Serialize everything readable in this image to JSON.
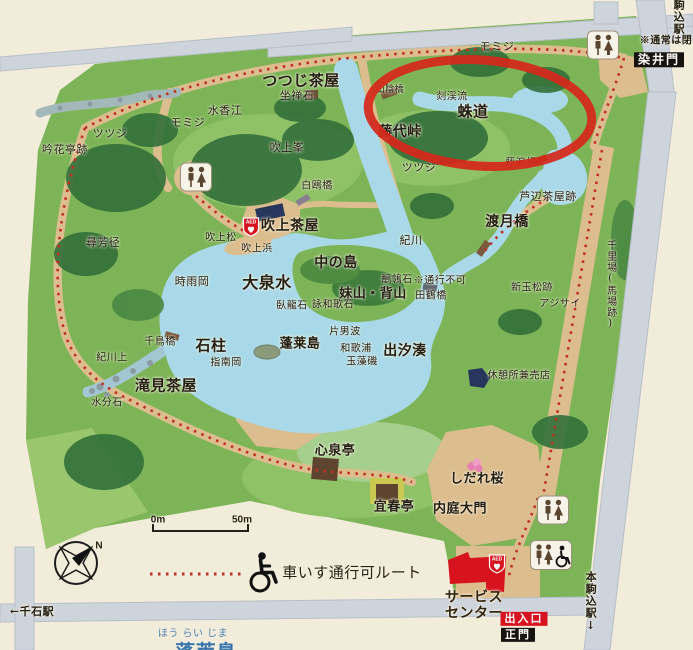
{
  "colors": {
    "paper": "#f2ecda",
    "park_green": "#7db457",
    "lake_blue": "#a9d9e8",
    "road_gray": "#ced4dc",
    "path_tan": "#dcbd8e",
    "route_red_dots": "#bf2f22",
    "annotation_red": "#d5281b",
    "gate_black": "#17130e",
    "entrance_red": "#d7131f",
    "caption_blue": "#4a7fad",
    "label_dark": "#241e13"
  },
  "map": {
    "labels": [
      {
        "name": "somei-note",
        "text": "※通常は閉",
        "x": 666,
        "y": 41,
        "size": 10,
        "bold": true
      },
      {
        "name": "komagome-station",
        "text": "駒込駅",
        "x": 678,
        "y": 17,
        "size": 11,
        "bold": true,
        "vertical": true
      },
      {
        "name": "somei-gate",
        "text": "染井門",
        "x": 659,
        "y": 60,
        "size": 12,
        "bold": true,
        "box": "black"
      },
      {
        "name": "momiji-ne",
        "text": "モミジ",
        "x": 497,
        "y": 47,
        "size": 11
      },
      {
        "name": "tsutsuji-chaya",
        "text": "つつじ茶屋",
        "x": 301,
        "y": 81,
        "size": 15,
        "bold": true
      },
      {
        "name": "zazen-ishi",
        "text": "坐禅石",
        "x": 297,
        "y": 96,
        "size": 11
      },
      {
        "name": "yamakage-bashi",
        "text": "山陰橋",
        "x": 390,
        "y": 90,
        "size": 9
      },
      {
        "name": "zankeiryu",
        "text": "剡渓流",
        "x": 452,
        "y": 97,
        "size": 10
      },
      {
        "name": "sasagani-no-michi",
        "text": "蛛道",
        "x": 473,
        "y": 112,
        "size": 15,
        "bold": true
      },
      {
        "name": "fujishiro-toge",
        "text": "藤代峠",
        "x": 400,
        "y": 133,
        "size": 14,
        "bold": true
      },
      {
        "name": "momiji-nw",
        "text": "モミジ",
        "x": 188,
        "y": 123,
        "size": 11
      },
      {
        "name": "suikoe",
        "text": "水香江",
        "x": 225,
        "y": 111,
        "size": 11
      },
      {
        "name": "tsutsuji-west",
        "text": "ツツジ",
        "x": 110,
        "y": 134,
        "size": 11
      },
      {
        "name": "ginkatei-ato",
        "text": "吟花亭跡",
        "x": 65,
        "y": 150,
        "size": 11
      },
      {
        "name": "fukiage-mine",
        "text": "吹上峯",
        "x": 287,
        "y": 148,
        "size": 11
      },
      {
        "name": "tsutsuji-east",
        "text": "ツツジ",
        "x": 419,
        "y": 168,
        "size": 11
      },
      {
        "name": "hakuo-bashi",
        "text": "白鴎橋",
        "x": 317,
        "y": 186,
        "size": 10
      },
      {
        "name": "fujinami-bashi",
        "text": "藤浪橋",
        "x": 521,
        "y": 163,
        "size": 10
      },
      {
        "name": "ashibe-chaya-ato",
        "text": "芦辺茶屋跡",
        "x": 548,
        "y": 197,
        "size": 11
      },
      {
        "name": "togetsu-kyo",
        "text": "渡月橋",
        "x": 507,
        "y": 223,
        "size": 14,
        "bold": true
      },
      {
        "name": "fukiage-chaya",
        "text": "吹上茶屋",
        "x": 290,
        "y": 227,
        "size": 14,
        "bold": true
      },
      {
        "name": "fukiage-matsu",
        "text": "吹上松",
        "x": 221,
        "y": 238,
        "size": 10
      },
      {
        "name": "fukiage-hama",
        "text": "吹上浜",
        "x": 257,
        "y": 249,
        "size": 10
      },
      {
        "name": "ki-no-kawa",
        "text": "紀川",
        "x": 411,
        "y": 241,
        "size": 11
      },
      {
        "name": "jinpokei",
        "text": "尋芳径",
        "x": 103,
        "y": 243,
        "size": 11
      },
      {
        "name": "shigure-oka",
        "text": "時雨岡",
        "x": 192,
        "y": 282,
        "size": 11
      },
      {
        "name": "daisensui",
        "text": "大泉水",
        "x": 267,
        "y": 283,
        "size": 16,
        "bold": true
      },
      {
        "name": "naka-no-shima",
        "text": "中の島",
        "x": 336,
        "y": 264,
        "size": 14,
        "bold": true
      },
      {
        "name": "imoyama-seyama",
        "text": "妹山・背山",
        "x": 373,
        "y": 295,
        "size": 13,
        "bold": true
      },
      {
        "name": "sekirei-ishi",
        "text": "鶺鴒石",
        "x": 397,
        "y": 280,
        "size": 10
      },
      {
        "name": "tsuko-fuka-note",
        "text": "※通行不可",
        "x": 440,
        "y": 281,
        "size": 10
      },
      {
        "name": "tazuru-bashi",
        "text": "田鶴橋",
        "x": 431,
        "y": 296,
        "size": 10
      },
      {
        "name": "garyu-seki",
        "text": "臥龍石",
        "x": 292,
        "y": 306,
        "size": 10
      },
      {
        "name": "eiwaka-ishi",
        "text": "詠和歌石",
        "x": 333,
        "y": 305,
        "size": 10
      },
      {
        "name": "kataonami",
        "text": "片男波",
        "x": 345,
        "y": 332,
        "size": 10
      },
      {
        "name": "horai-jima",
        "text": "蓬莱島",
        "x": 300,
        "y": 345,
        "size": 13,
        "bold": true
      },
      {
        "name": "waka-no-ura",
        "text": "和歌浦",
        "x": 356,
        "y": 349,
        "size": 10
      },
      {
        "name": "tamamo-iso",
        "text": "玉藻磯",
        "x": 362,
        "y": 362,
        "size": 10
      },
      {
        "name": "deshio-minato",
        "text": "出汐湊",
        "x": 405,
        "y": 352,
        "size": 14,
        "bold": true
      },
      {
        "name": "chidori-bashi",
        "text": "千鳥橋",
        "x": 160,
        "y": 342,
        "size": 10
      },
      {
        "name": "sekichu",
        "text": "石柱",
        "x": 211,
        "y": 346,
        "size": 15,
        "bold": true
      },
      {
        "name": "kigawa-kami",
        "text": "紀川上",
        "x": 112,
        "y": 358,
        "size": 10
      },
      {
        "name": "shirube-oka",
        "text": "指南岡",
        "x": 226,
        "y": 363,
        "size": 10
      },
      {
        "name": "takimi-chaya",
        "text": "滝見茶屋",
        "x": 166,
        "y": 386,
        "size": 15,
        "bold": true
      },
      {
        "name": "mizuwake-ishi",
        "text": "水分石",
        "x": 107,
        "y": 403,
        "size": 10
      },
      {
        "name": "aratama-matsu-ato",
        "text": "新玉松跡",
        "x": 532,
        "y": 288,
        "size": 10
      },
      {
        "name": "ajisai",
        "text": "アジサイ",
        "x": 560,
        "y": 304,
        "size": 10
      },
      {
        "name": "kyukeijo-baiten",
        "text": "休憩所兼売店",
        "x": 519,
        "y": 376,
        "size": 10
      },
      {
        "name": "senriba-babaato",
        "text": "千里場(馬場跡)",
        "x": 610,
        "y": 285,
        "size": 10,
        "vertical": true
      },
      {
        "name": "shinsen-tei",
        "text": "心泉亭",
        "x": 335,
        "y": 452,
        "size": 13,
        "bold": true
      },
      {
        "name": "gishun-tei",
        "text": "宜春亭",
        "x": 394,
        "y": 508,
        "size": 13,
        "bold": true
      },
      {
        "name": "naitei-daimon",
        "text": "内庭大門",
        "x": 460,
        "y": 510,
        "size": 13,
        "bold": true
      },
      {
        "name": "shidare-zakura",
        "text": "しだれ桜",
        "x": 477,
        "y": 480,
        "size": 13,
        "bold": true
      },
      {
        "name": "service-center",
        "text": "サービス\nセンター",
        "x": 474,
        "y": 606,
        "size": 14,
        "bold": true,
        "color": "#33250f"
      },
      {
        "name": "entrance",
        "text": "出入口",
        "x": 524,
        "y": 619,
        "size": 11,
        "bold": true,
        "box": "red"
      },
      {
        "name": "main-gate",
        "text": "正門",
        "x": 518,
        "y": 635,
        "size": 11,
        "bold": true,
        "box": "black"
      },
      {
        "name": "hon-komagome-station",
        "text": "本駒込駅↓",
        "x": 590,
        "y": 602,
        "size": 11,
        "bold": true,
        "vertical": true
      },
      {
        "name": "sengoku-station",
        "text": "←千石駅",
        "x": 32,
        "y": 612,
        "size": 11,
        "bold": true
      },
      {
        "name": "scale-zero",
        "text": "0m",
        "x": 158,
        "y": 520,
        "size": 10,
        "bold": true,
        "sans": true
      },
      {
        "name": "scale-fifty",
        "text": "50m",
        "x": 242,
        "y": 520,
        "size": 10,
        "bold": true,
        "sans": true
      },
      {
        "name": "wheelchair-route",
        "text": "車いす通行可ルート",
        "x": 352,
        "y": 573,
        "size": 15
      },
      {
        "name": "compass-north",
        "text": "N",
        "x": 99,
        "y": 546,
        "size": 10,
        "bold": true,
        "sans": true
      },
      {
        "name": "caption-furigana",
        "text": "ほう らい じま",
        "x": 193,
        "y": 634,
        "size": 10,
        "color": "#4a7fad"
      },
      {
        "name": "caption-title",
        "text": "蓬莱島",
        "x": 206,
        "y": 652,
        "size": 20,
        "bold": true,
        "color": "#3a76ad"
      }
    ],
    "icons": [
      {
        "name": "toilet-icon-north",
        "type": "toilet",
        "x": 603,
        "y": 45
      },
      {
        "name": "toilet-icon-west",
        "type": "toilet",
        "x": 196,
        "y": 177
      },
      {
        "name": "toilet-icon-south",
        "type": "toilet",
        "x": 553,
        "y": 510
      },
      {
        "name": "accessible-toilet-icon",
        "type": "toilet-accessible",
        "x": 551,
        "y": 555
      },
      {
        "name": "aed-icon-fukiage",
        "type": "aed",
        "x": 251,
        "y": 227
      },
      {
        "name": "aed-icon-service-center",
        "type": "aed",
        "x": 497,
        "y": 564
      },
      {
        "name": "wheelchair-icon-legend",
        "type": "wheelchair",
        "x": 264,
        "y": 572
      },
      {
        "name": "blossom-icon",
        "type": "blossom",
        "x": 475,
        "y": 466
      }
    ]
  }
}
